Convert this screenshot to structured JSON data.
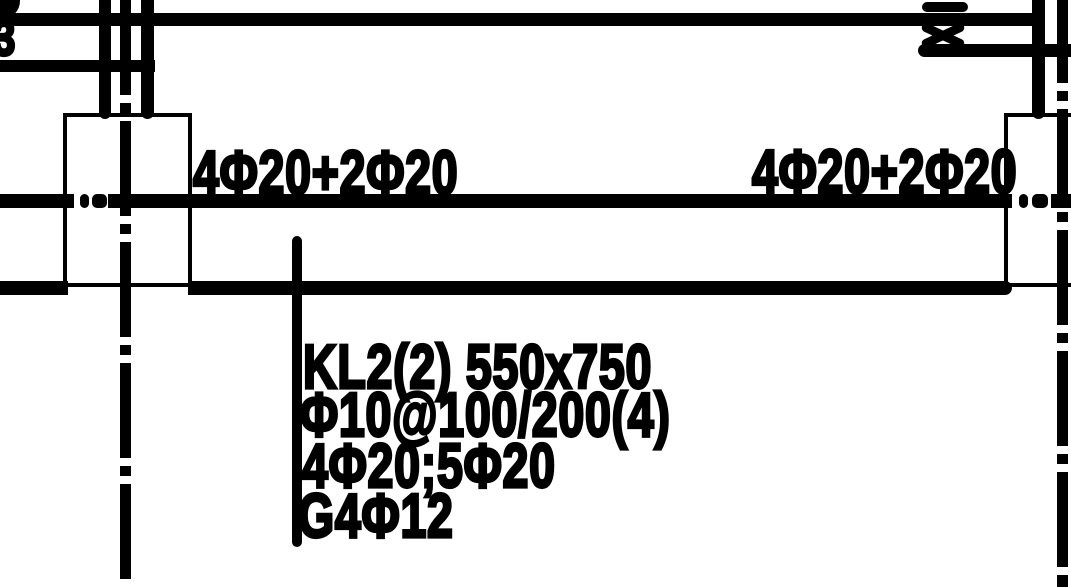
{
  "drawing": {
    "background": "#ffffff",
    "ink": "#000000",
    "edge_fragment": "3",
    "top_rebar_left": "4Φ20+2Φ20",
    "top_rebar_right": "4Φ20+2Φ20",
    "beam_tag": {
      "name_size": "KL2(2) 550x750",
      "stirrups": "Φ10@100/200(4)",
      "main_bars": "4Φ20;5Φ20",
      "side_bars": "G4Φ12"
    }
  }
}
